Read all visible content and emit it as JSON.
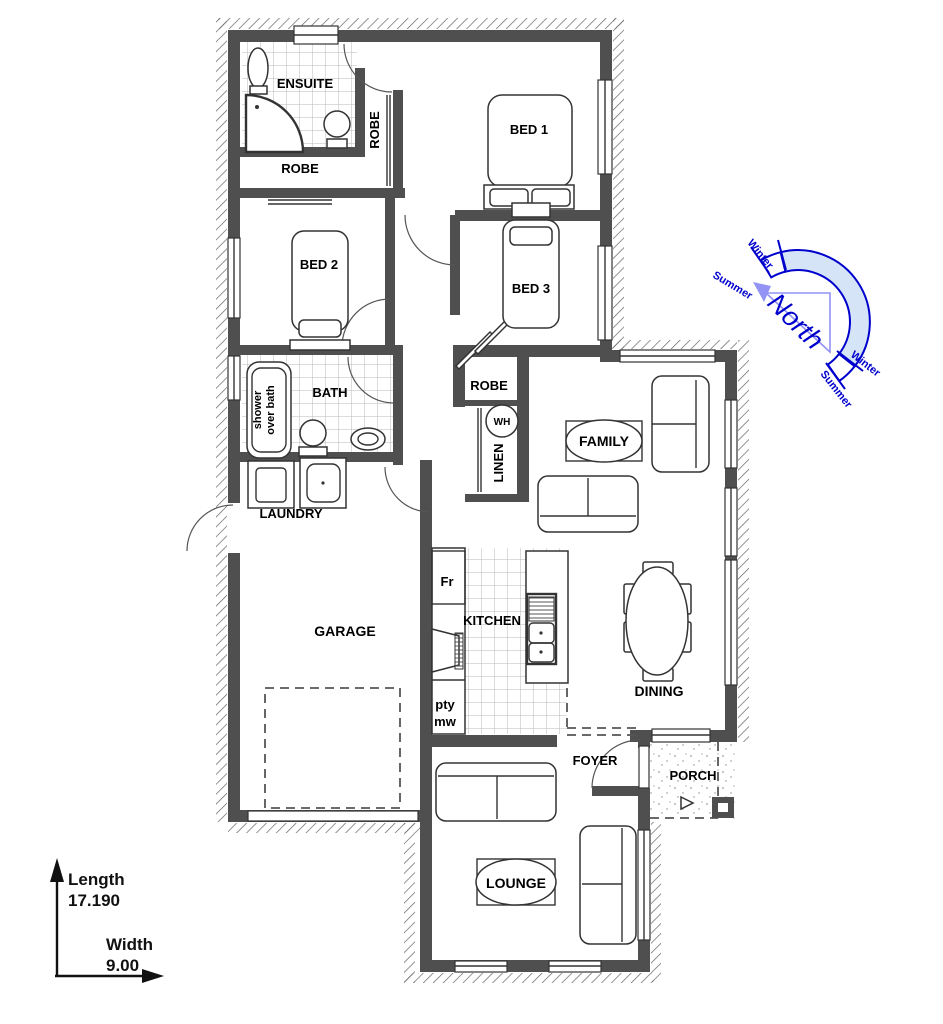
{
  "labels": {
    "ensuite": "ENSUITE",
    "robe_ensuite": "ROBE",
    "robe_bed2": "ROBE",
    "robe_hall": "ROBE",
    "bed1": "BED 1",
    "bed2": "BED 2",
    "bed3": "BED 3",
    "bath": "BATH",
    "shower_line1": "shower",
    "shower_line2": "over bath",
    "wh": "WH",
    "linen": "LINEN",
    "family": "FAMILY",
    "laundry": "LAUNDRY",
    "garage": "GARAGE",
    "kitchen": "KITCHEN",
    "fridge": "Fr",
    "pantry": "pty",
    "microwave": "mw",
    "dining": "DINING",
    "foyer": "FOYER",
    "porch": "PORCH",
    "lounge": "LOUNGE"
  },
  "compass": {
    "north": "North",
    "winter_top": "Winter",
    "summer_top": "Summer",
    "winter_bottom": "Winter",
    "summer_bottom": "Summer"
  },
  "dimensions": {
    "length_label": "Length",
    "length_value": "17.190",
    "width_label": "Width",
    "width_value": "9.00"
  },
  "colors": {
    "wall": "#4f4f4f",
    "line": "#333333",
    "compass_stroke": "#0000cd",
    "compass_fill": "#d6e4f7",
    "compass_arrow": "#9393f5"
  }
}
